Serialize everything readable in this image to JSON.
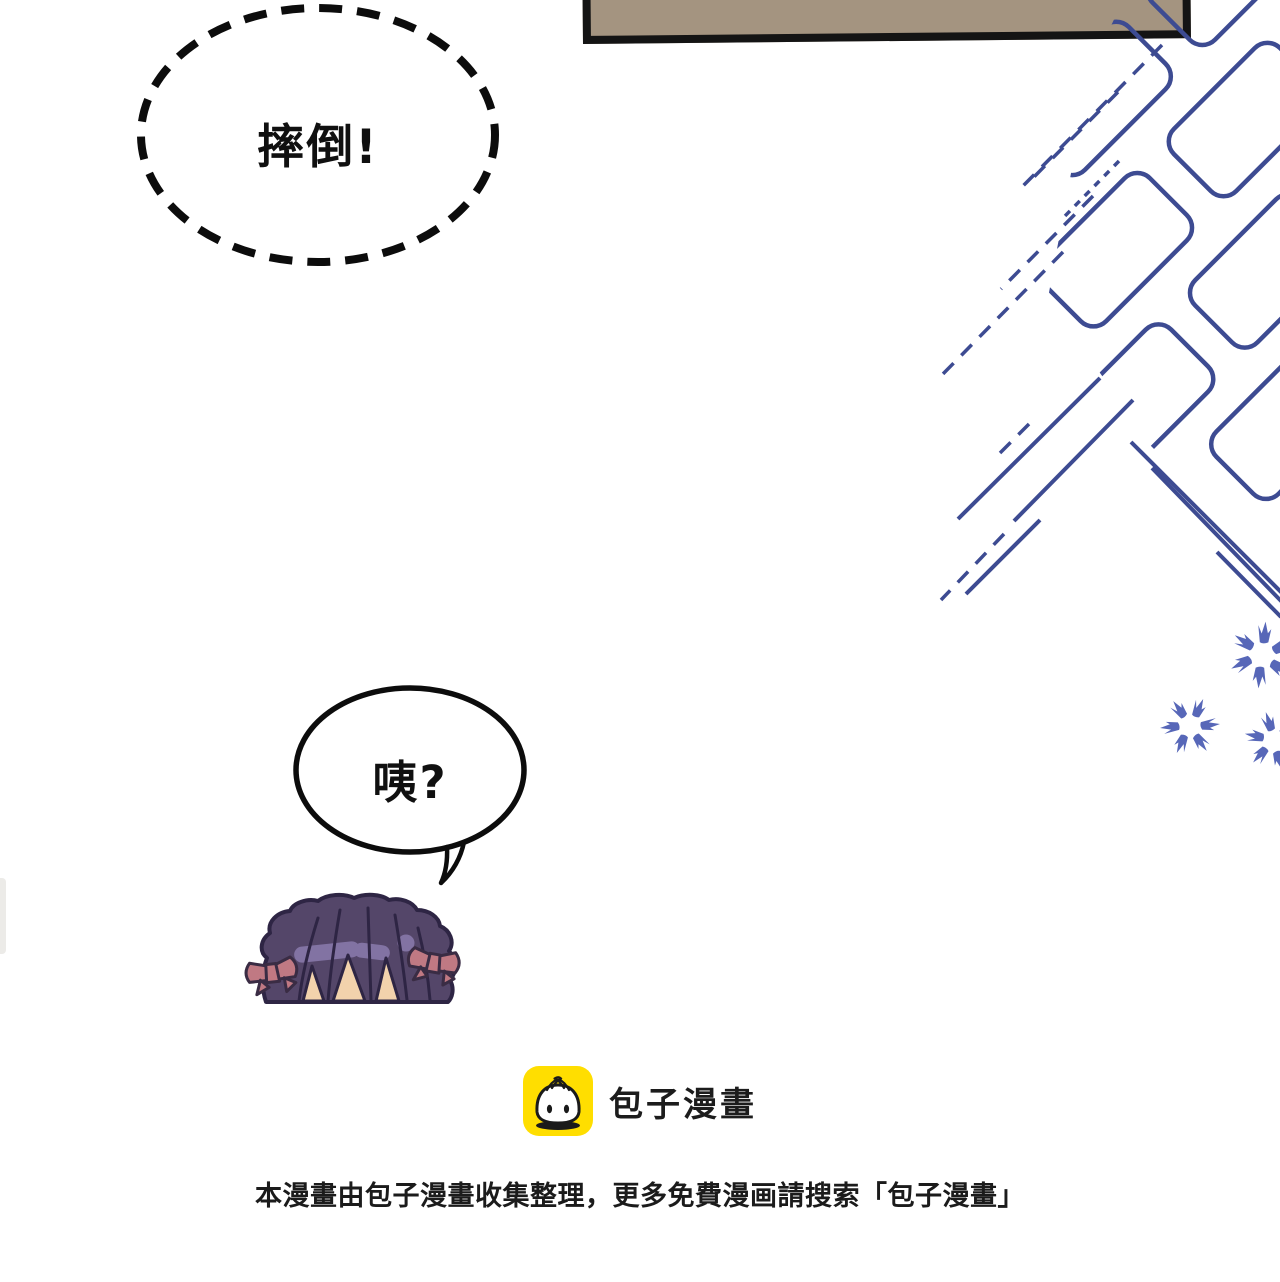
{
  "page": {
    "width": 1280,
    "height": 1282,
    "background": "#ffffff"
  },
  "panel": {
    "fill": "#a49480",
    "border_color": "#141414"
  },
  "speech_bubbles": {
    "dashed_bubble": {
      "text": "摔倒!",
      "shape": "dashed-ellipse",
      "stroke": "#0c0c0c"
    },
    "round_bubble": {
      "text": "咦?",
      "shape": "solid-ellipse-with-tail",
      "stroke": "#0c0c0c"
    }
  },
  "effects": {
    "lattice_color": "#3d4b92",
    "sparkle_color": "#5767b8"
  },
  "character": {
    "description": "chibi-girl-head-peeking",
    "hair_color": "#544669",
    "hair_outline": "#2e2544",
    "hair_highlight": "#8273a3",
    "bow_color": "#c07983",
    "skin_color": "#f2d2ac"
  },
  "branding": {
    "logo_label": "包子漫畫",
    "logo_bg": "#ffde00",
    "logo_icon": "baozi-bun-icon",
    "disclaimer": "本漫畫由包子漫畫收集整理，更多免費漫画請搜索「包子漫畫」"
  }
}
